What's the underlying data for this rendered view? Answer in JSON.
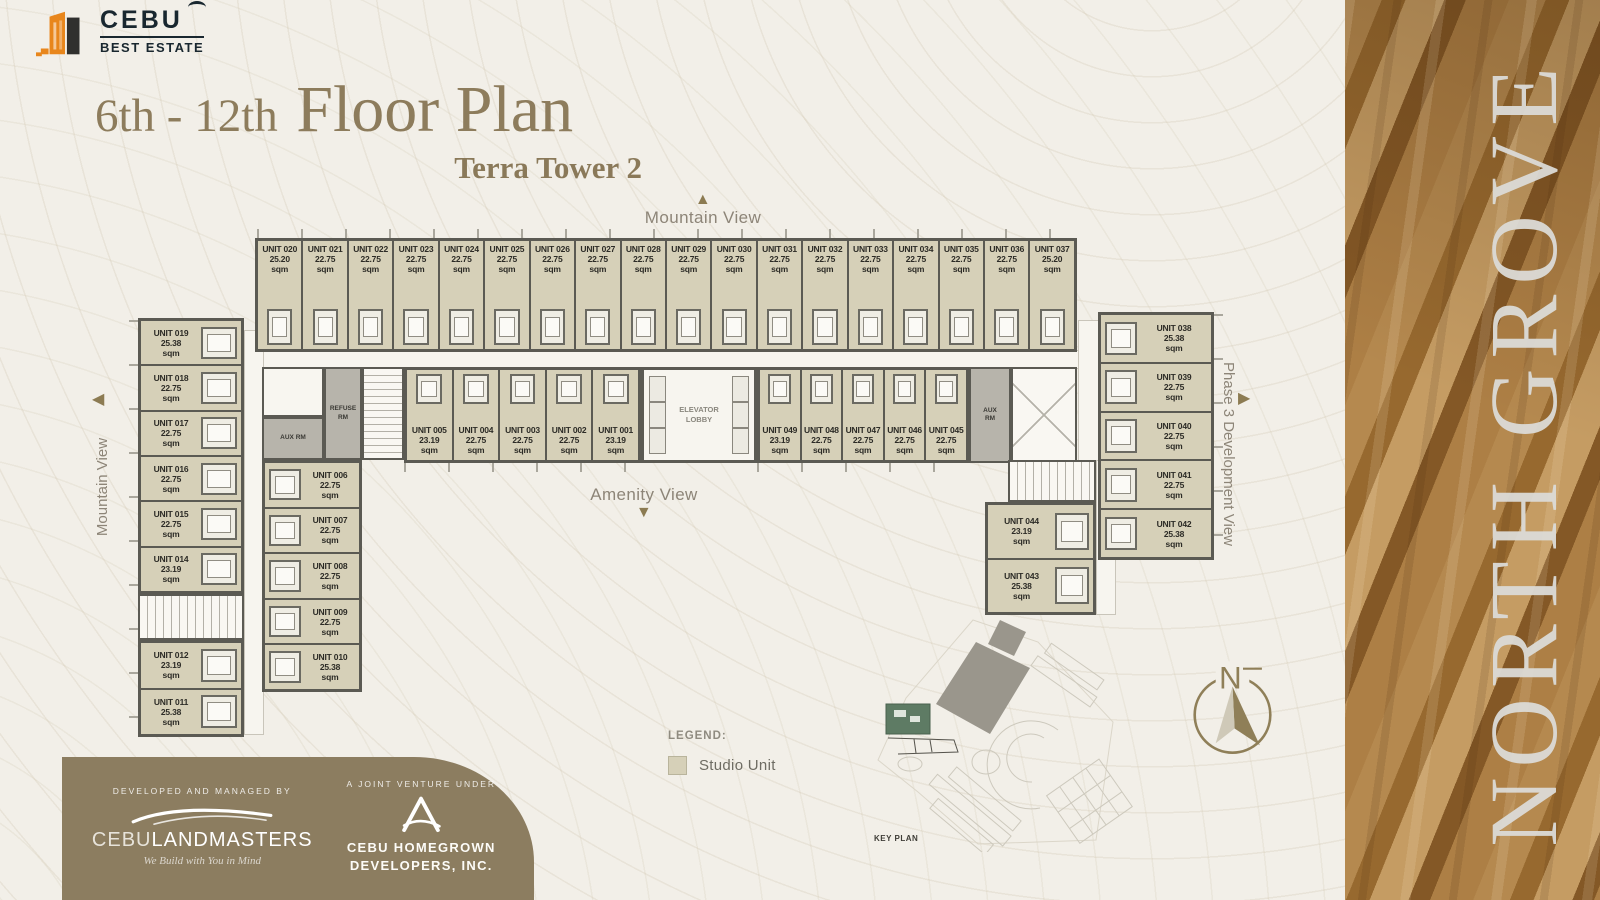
{
  "brand": {
    "name": "CEBU",
    "subname": "BEST ESTATE"
  },
  "header": {
    "title_prefix": "6th - 12th",
    "title_main": "Floor Plan",
    "subtitle": "Terra Tower 2"
  },
  "views": {
    "top": "Mountain View",
    "left": "Mountain View",
    "bottom": "Amenity View",
    "right": "Phase 3 Development View"
  },
  "plan": {
    "area_unit": "sqm",
    "top_row": [
      {
        "id": "UNIT 020",
        "area": "25.20"
      },
      {
        "id": "UNIT 021",
        "area": "22.75"
      },
      {
        "id": "UNIT 022",
        "area": "22.75"
      },
      {
        "id": "UNIT 023",
        "area": "22.75"
      },
      {
        "id": "UNIT 024",
        "area": "22.75"
      },
      {
        "id": "UNIT 025",
        "area": "22.75"
      },
      {
        "id": "UNIT 026",
        "area": "22.75"
      },
      {
        "id": "UNIT 027",
        "area": "22.75"
      },
      {
        "id": "UNIT 028",
        "area": "22.75"
      },
      {
        "id": "UNIT 029",
        "area": "22.75"
      },
      {
        "id": "UNIT 030",
        "area": "22.75"
      },
      {
        "id": "UNIT 031",
        "area": "22.75"
      },
      {
        "id": "UNIT 032",
        "area": "22.75"
      },
      {
        "id": "UNIT 033",
        "area": "22.75"
      },
      {
        "id": "UNIT 034",
        "area": "22.75"
      },
      {
        "id": "UNIT 035",
        "area": "22.75"
      },
      {
        "id": "UNIT 036",
        "area": "22.75"
      },
      {
        "id": "UNIT 037",
        "area": "25.20"
      }
    ],
    "left_wing_upper": [
      {
        "id": "UNIT 019",
        "area": "25.38"
      },
      {
        "id": "UNIT 018",
        "area": "22.75"
      },
      {
        "id": "UNIT 017",
        "area": "22.75"
      },
      {
        "id": "UNIT 016",
        "area": "22.75"
      },
      {
        "id": "UNIT 015",
        "area": "22.75"
      },
      {
        "id": "UNIT 014",
        "area": "23.19"
      }
    ],
    "left_wing_lower": [
      {
        "id": "UNIT 012",
        "area": "23.19"
      },
      {
        "id": "UNIT 011",
        "area": "25.38"
      }
    ],
    "inner_col": [
      {
        "id": "UNIT 006",
        "area": "22.75"
      },
      {
        "id": "UNIT 007",
        "area": "22.75"
      },
      {
        "id": "UNIT 008",
        "area": "22.75"
      },
      {
        "id": "UNIT 009",
        "area": "22.75"
      },
      {
        "id": "UNIT 010",
        "area": "25.38"
      }
    ],
    "mid_left": [
      {
        "id": "UNIT 005",
        "area": "23.19"
      },
      {
        "id": "UNIT 004",
        "area": "22.75"
      },
      {
        "id": "UNIT 003",
        "area": "22.75"
      },
      {
        "id": "UNIT 002",
        "area": "22.75"
      },
      {
        "id": "UNIT 001",
        "area": "23.19"
      }
    ],
    "mid_right": [
      {
        "id": "UNIT 049",
        "area": "23.19"
      },
      {
        "id": "UNIT 048",
        "area": "22.75"
      },
      {
        "id": "UNIT 047",
        "area": "22.75"
      },
      {
        "id": "UNIT 046",
        "area": "22.75"
      },
      {
        "id": "UNIT 045",
        "area": "22.75"
      }
    ],
    "right_wing": [
      {
        "id": "UNIT 038",
        "area": "25.38"
      },
      {
        "id": "UNIT 039",
        "area": "22.75"
      },
      {
        "id": "UNIT 040",
        "area": "22.75"
      },
      {
        "id": "UNIT 041",
        "area": "22.75"
      },
      {
        "id": "UNIT 042",
        "area": "25.38"
      }
    ],
    "lower_right": [
      {
        "id": "UNIT 044",
        "area": "23.19"
      },
      {
        "id": "UNIT 043",
        "area": "25.38"
      }
    ],
    "rooms": {
      "aux_left": "AUX RM",
      "refuse": "REFUSE\nRM",
      "elevator": "ELEVATOR\nLOBBY",
      "aux_right": "AUX\nRM"
    }
  },
  "legend": {
    "heading": "LEGEND:",
    "item_label": "Studio Unit"
  },
  "key_plan": {
    "label": "KEY PLAN"
  },
  "compass": {
    "label": "N"
  },
  "side_panel": {
    "title": "NORTH GROVE"
  },
  "footer": {
    "developed_label": "DEVELOPED AND MANAGED BY",
    "developer_name_1": "CEBU",
    "developer_name_2": "LANDMASTERS",
    "developer_tagline": "We Build with You in Mind",
    "jv_label": "A JOINT VENTURE UNDER",
    "jv_name": "CEBU HOMEGROWN\nDEVELOPERS, INC."
  },
  "colors": {
    "studio_fill": "#d6d0b8",
    "wall": "#5b5a53",
    "banner": "#8c7d60",
    "accent": "#8c7b52",
    "background": "#f2efe8"
  }
}
